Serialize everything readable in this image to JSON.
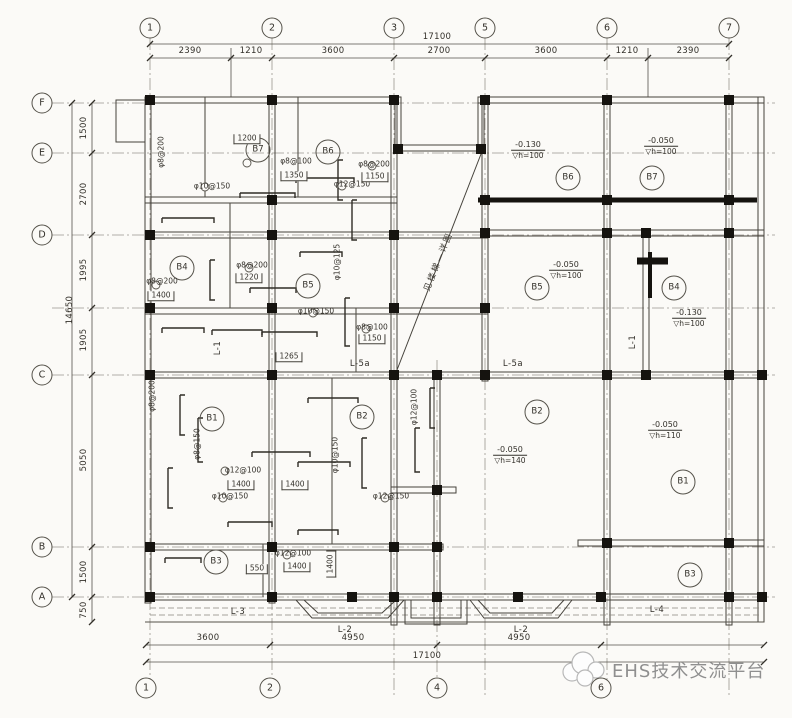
{
  "axes": {
    "top": [
      {
        "label": "1",
        "x": 150
      },
      {
        "label": "2",
        "x": 272
      },
      {
        "label": "3",
        "x": 394
      },
      {
        "label": "5",
        "x": 485
      },
      {
        "label": "6",
        "x": 607
      },
      {
        "label": "7",
        "x": 729
      }
    ],
    "bottom": [
      {
        "label": "1",
        "x": 146
      },
      {
        "label": "2",
        "x": 270
      },
      {
        "label": "4",
        "x": 437
      },
      {
        "label": "6",
        "x": 601
      }
    ],
    "left": [
      {
        "label": "F",
        "y": 103
      },
      {
        "label": "E",
        "y": 153
      },
      {
        "label": "D",
        "y": 235
      },
      {
        "label": "C",
        "y": 375
      },
      {
        "label": "B",
        "y": 547
      },
      {
        "label": "A",
        "y": 597
      }
    ]
  },
  "dimensions": {
    "top_total": {
      "t": "17100",
      "x": 437
    },
    "top_segments": [
      {
        "t": "2390",
        "x": 190
      },
      {
        "t": "1210",
        "x": 251
      },
      {
        "t": "3600",
        "x": 333
      },
      {
        "t": "2700",
        "x": 439
      },
      {
        "t": "3600",
        "x": 546
      },
      {
        "t": "1210",
        "x": 627
      },
      {
        "t": "2390",
        "x": 688
      }
    ],
    "bottom_segments": [
      {
        "t": "3600",
        "x": 208
      },
      {
        "t": "4950",
        "x": 353
      },
      {
        "t": "4950",
        "x": 519
      }
    ],
    "bottom_total": {
      "t": "17100",
      "x": 427
    },
    "left_total": {
      "t": "14650",
      "y": 310
    },
    "left_segments": [
      {
        "t": "1500",
        "y": 128
      },
      {
        "t": "2700",
        "y": 194
      },
      {
        "t": "1995",
        "y": 270
      },
      {
        "t": "1905",
        "y": 340
      },
      {
        "t": "5050",
        "y": 460
      },
      {
        "t": "1500",
        "y": 572
      },
      {
        "t": "750",
        "y": 610
      }
    ]
  },
  "rooms": [
    {
      "t": "B7",
      "x": 258,
      "y": 150
    },
    {
      "t": "B6",
      "x": 328,
      "y": 152
    },
    {
      "t": "B4",
      "x": 182,
      "y": 268
    },
    {
      "t": "B5",
      "x": 308,
      "y": 286
    },
    {
      "t": "B1",
      "x": 212,
      "y": 419
    },
    {
      "t": "B2",
      "x": 362,
      "y": 417
    },
    {
      "t": "B3",
      "x": 216,
      "y": 562
    },
    {
      "t": "B6",
      "x": 568,
      "y": 178
    },
    {
      "t": "B7",
      "x": 652,
      "y": 178
    },
    {
      "t": "B5",
      "x": 537,
      "y": 288
    },
    {
      "t": "B4",
      "x": 674,
      "y": 288
    },
    {
      "t": "B2",
      "x": 537,
      "y": 412
    },
    {
      "t": "B1",
      "x": 683,
      "y": 482
    },
    {
      "t": "B3",
      "x": 690,
      "y": 575
    }
  ],
  "elevation_symbol": "▽",
  "elevations": [
    {
      "v": "-0.130",
      "h": "h=100",
      "x": 528,
      "y": 150
    },
    {
      "v": "-0.050",
      "h": "h=100",
      "x": 661,
      "y": 146
    },
    {
      "v": "-0.050",
      "h": "h=100",
      "x": 566,
      "y": 270
    },
    {
      "v": "-0.130",
      "h": "h=100",
      "x": 689,
      "y": 318
    },
    {
      "v": "-0.050",
      "h": "h=140",
      "x": 510,
      "y": 455
    },
    {
      "v": "-0.050",
      "h": "h=110",
      "x": 665,
      "y": 430
    }
  ],
  "beams": [
    {
      "t": "L-1",
      "x": 218,
      "y": 348,
      "vert": 1
    },
    {
      "t": "L-1",
      "x": 633,
      "y": 342,
      "vert": 1
    },
    {
      "t": "L-5a",
      "x": 360,
      "y": 364
    },
    {
      "t": "L-5a",
      "x": 513,
      "y": 364
    },
    {
      "t": "L-3",
      "x": 238,
      "y": 612
    },
    {
      "t": "L-2",
      "x": 345,
      "y": 630
    },
    {
      "t": "L-2",
      "x": 521,
      "y": 630
    },
    {
      "t": "L-4",
      "x": 657,
      "y": 610
    }
  ],
  "rebar_notes": [
    {
      "t": "φ8@100",
      "x": 296,
      "y": 161
    },
    {
      "t": "φ8@200",
      "x": 374,
      "y": 164
    },
    {
      "t": "φ10@150",
      "x": 212,
      "y": 186
    },
    {
      "t": "φ12@150",
      "x": 352,
      "y": 184
    },
    {
      "t": "φ8@200",
      "x": 161,
      "y": 152,
      "vert": 1
    },
    {
      "t": "φ8@200",
      "x": 252,
      "y": 265
    },
    {
      "t": "φ10@125",
      "x": 337,
      "y": 262,
      "vert": 1
    },
    {
      "t": "φ10@150",
      "x": 316,
      "y": 311
    },
    {
      "t": "φ8@100",
      "x": 372,
      "y": 327
    },
    {
      "t": "φ8@200",
      "x": 162,
      "y": 281
    },
    {
      "t": "φ8@150",
      "x": 197,
      "y": 444,
      "vert": 1
    },
    {
      "t": "φ12@100",
      "x": 243,
      "y": 470
    },
    {
      "t": "φ10@150",
      "x": 230,
      "y": 496
    },
    {
      "t": "φ12@150",
      "x": 391,
      "y": 496
    },
    {
      "t": "φ10@150",
      "x": 335,
      "y": 455,
      "vert": 1
    },
    {
      "t": "φ12@100",
      "x": 414,
      "y": 407,
      "vert": 1
    },
    {
      "t": "φ12@100",
      "x": 293,
      "y": 553
    },
    {
      "t": "φ8@200",
      "x": 152,
      "y": 396,
      "vert": 1
    }
  ],
  "segment_dims": [
    {
      "t": "1350",
      "x": 294,
      "y": 176
    },
    {
      "t": "1150",
      "x": 375,
      "y": 177
    },
    {
      "t": "1200",
      "x": 247,
      "y": 139
    },
    {
      "t": "1220",
      "x": 249,
      "y": 278
    },
    {
      "t": "1150",
      "x": 372,
      "y": 339
    },
    {
      "t": "1265",
      "x": 289,
      "y": 357
    },
    {
      "t": "1400",
      "x": 161,
      "y": 296
    },
    {
      "t": "1400",
      "x": 241,
      "y": 485
    },
    {
      "t": "1400",
      "x": 295,
      "y": 485
    },
    {
      "t": "550",
      "x": 257,
      "y": 569
    },
    {
      "t": "1400",
      "x": 297,
      "y": 567
    },
    {
      "t": "1400",
      "x": 331,
      "y": 564,
      "vert": 1
    }
  ],
  "stair_note": {
    "t": "见楼梯—详图",
    "x": 439,
    "y": 262
  },
  "watermark": {
    "text": "EHS技术交流平台"
  }
}
